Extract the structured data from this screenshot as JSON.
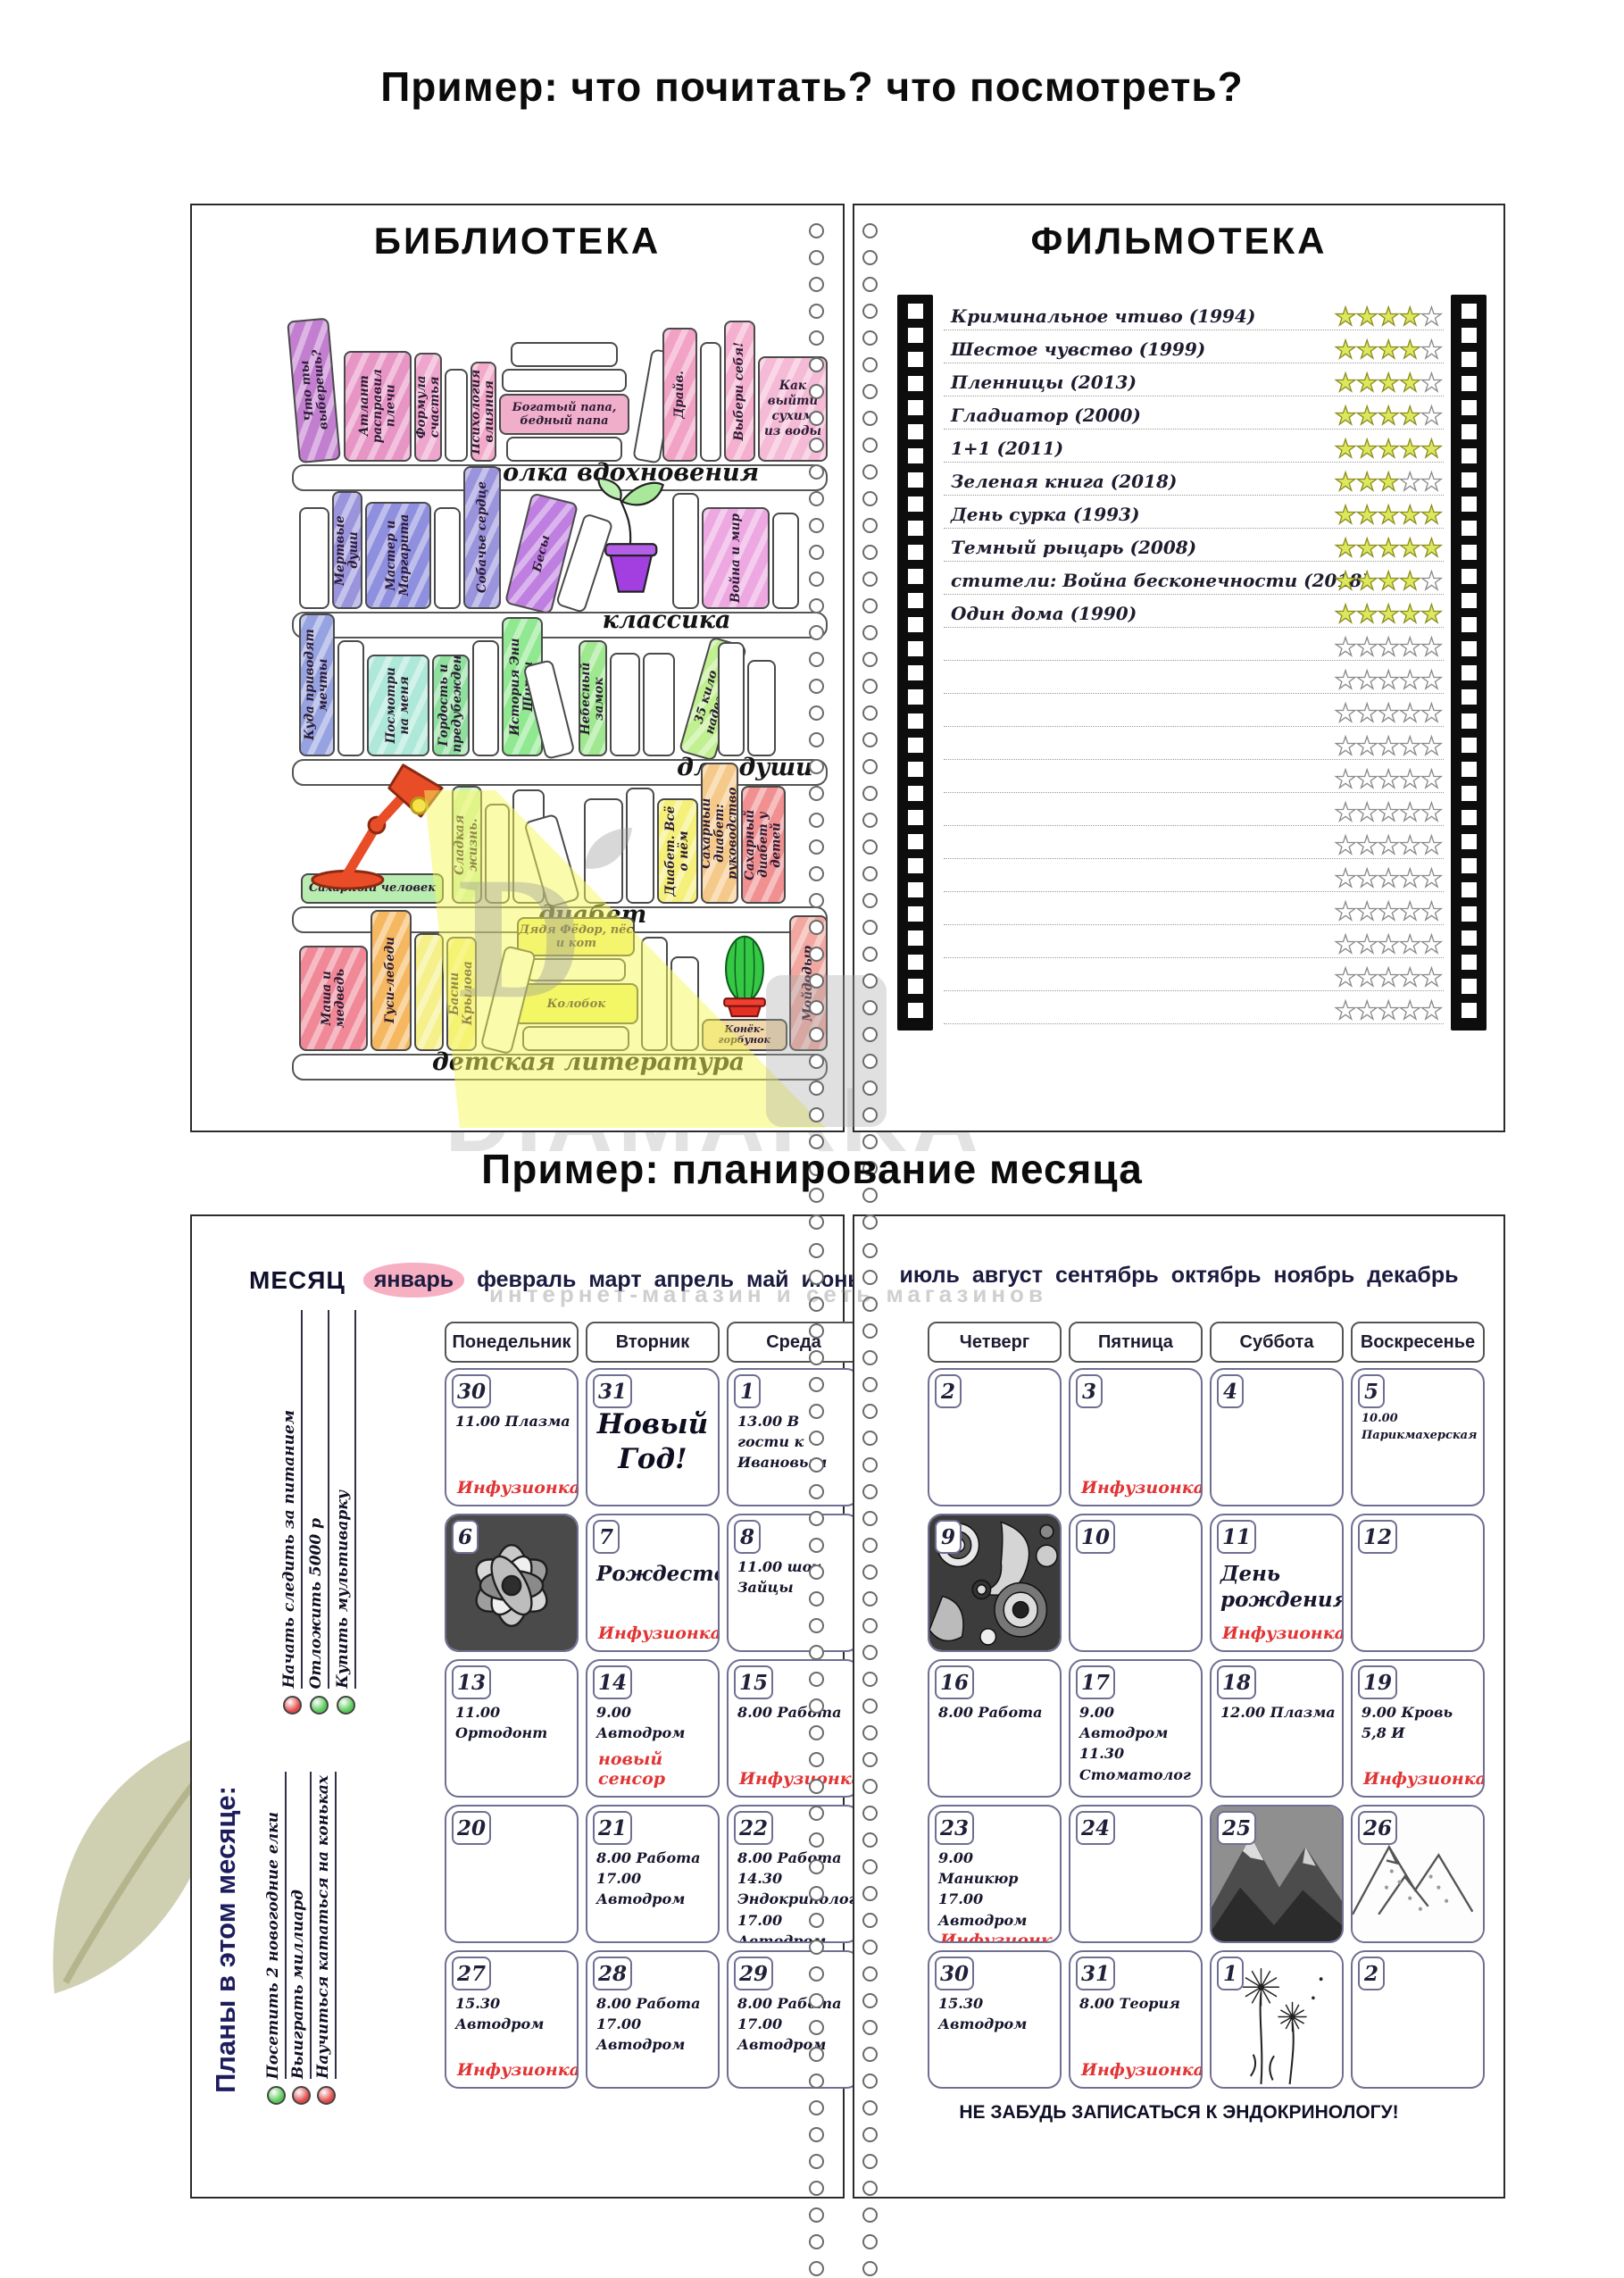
{
  "captions": {
    "top": "Пример: что почитать? что посмотреть?",
    "bottom": "Пример: планирование месяца"
  },
  "watermark": {
    "brand": "DIAMARKA",
    "subtitle": "интернет-магазин и сеть магазинов",
    "logo_letter": "D"
  },
  "library": {
    "title": "БИБЛИОТЕКА",
    "shelves": [
      {
        "label": "полка вдохновения",
        "books": [
          {
            "t": "Что ты выберешь?",
            "c": "#c27fd0",
            "w": 48,
            "h": 160,
            "tilt": -5
          },
          {
            "t": "Атлант расправил плечи",
            "c": "#e795c5",
            "w": 78,
            "h": 124
          },
          {
            "t": "Формула счастья",
            "c": "#eea6cd",
            "w": 32,
            "h": 122
          },
          {
            "t": "",
            "c": "#ffffff",
            "w": 26,
            "h": 104
          },
          {
            "t": "Психология влияния",
            "c": "#f3a9c9",
            "w": 30,
            "h": 112
          },
          {
            "kind": "stack",
            "books": [
              {
                "t": "",
                "c": "#ffffff",
                "w": 120,
                "h": 28
              },
              {
                "t": "",
                "c": "#ffffff",
                "w": 140,
                "h": 26
              },
              {
                "t": "Богатый папа, бедный папа",
                "c": "#f0aecb",
                "w": 146,
                "h": 46
              },
              {
                "t": "",
                "c": "#ffffff",
                "w": 130,
                "h": 28
              }
            ]
          },
          {
            "t": "",
            "c": "#ffffff",
            "w": 32,
            "h": 126,
            "tilt": 10
          },
          {
            "t": "Драйв.",
            "c": "#f2a2c4",
            "w": 40,
            "h": 150
          },
          {
            "t": "",
            "c": "#ffffff",
            "w": 24,
            "h": 134
          },
          {
            "t": "Выбери себя!",
            "c": "#f4b0ce",
            "w": 36,
            "h": 158
          },
          {
            "t": "Как выйти сухим из воды",
            "c": "#f4bad6",
            "w": 80,
            "h": 118,
            "flat": true
          }
        ]
      },
      {
        "label": "классика",
        "books": [
          {
            "t": "",
            "c": "#ffffff",
            "w": 34,
            "h": 114
          },
          {
            "t": "Мертвые души",
            "c": "#9a94dd",
            "w": 34,
            "h": 132
          },
          {
            "t": "Мастер и Маргарита",
            "c": "#8f8fdf",
            "w": 74,
            "h": 120
          },
          {
            "t": "",
            "c": "#ffffff",
            "w": 30,
            "h": 114
          },
          {
            "t": "Собачье сердце",
            "c": "#9a94dd",
            "w": 42,
            "h": 160
          },
          {
            "t": "Бесы",
            "c": "#bf7fe0",
            "w": 54,
            "h": 128,
            "tilt": 14
          },
          {
            "t": "",
            "c": "#ffffff",
            "w": 34,
            "h": 108,
            "tilt": 18
          },
          {
            "kind": "plant"
          },
          {
            "t": "",
            "c": "#ffffff",
            "w": 30,
            "h": 130
          },
          {
            "t": "Война и мир",
            "c": "#eda8e2",
            "w": 76,
            "h": 114
          },
          {
            "t": "",
            "c": "#ffffff",
            "w": 30,
            "h": 108
          }
        ]
      },
      {
        "label": "для души",
        "books": [
          {
            "t": "Куда приводят мечты",
            "c": "#97a3e0",
            "w": 40,
            "h": 160
          },
          {
            "t": "",
            "c": "#ffffff",
            "w": 30,
            "h": 130
          },
          {
            "t": "Посмотри на меня",
            "c": "#aee8d8",
            "w": 70,
            "h": 114
          },
          {
            "t": "Гордость и предубеждение",
            "c": "#8fdf9f",
            "w": 42,
            "h": 114
          },
          {
            "t": "",
            "c": "#ffffff",
            "w": 30,
            "h": 130
          },
          {
            "t": "История Эни Ширли",
            "c": "#90e890",
            "w": 46,
            "h": 156
          },
          {
            "t": "",
            "c": "#ffffff",
            "w": 34,
            "h": 108,
            "tilt": -14
          },
          {
            "t": "Небесный замок",
            "c": "#9fe88f",
            "w": 32,
            "h": 130
          },
          {
            "t": "",
            "c": "#ffffff",
            "w": 34,
            "h": 116
          },
          {
            "t": "",
            "c": "#ffffff",
            "w": 36,
            "h": 116
          },
          {
            "t": "35 кило надежды",
            "c": "#c0f090",
            "w": 42,
            "h": 134,
            "tilt": 16
          },
          {
            "t": "",
            "c": "#ffffff",
            "w": 30,
            "h": 128
          },
          {
            "t": "",
            "c": "#ffffff",
            "w": 32,
            "h": 108
          }
        ]
      },
      {
        "label": "диабет",
        "books": [
          {
            "kind": "lampstack",
            "base": "Сахарный человек"
          },
          {
            "t": "Сладкая жизнь.",
            "c": "#c9f0b8",
            "w": 34,
            "h": 132
          },
          {
            "t": "",
            "c": "#ffffff",
            "w": 28,
            "h": 112
          },
          {
            "t": "",
            "c": "#ffffff",
            "w": 36,
            "h": 128
          },
          {
            "t": "",
            "c": "#ffffff",
            "w": 38,
            "h": 100,
            "tilt": -16
          },
          {
            "t": "",
            "c": "#ffffff",
            "w": 44,
            "h": 118
          },
          {
            "t": "",
            "c": "#ffffff",
            "w": 32,
            "h": 130
          },
          {
            "t": "Диабет. Всё о нём",
            "c": "#f5f07a",
            "w": 46,
            "h": 118
          },
          {
            "t": "Сахарный диабет: руководство",
            "c": "#f5c98a",
            "w": 42,
            "h": 158
          },
          {
            "t": "Сахарный диабет у детей",
            "c": "#f09090",
            "w": 50,
            "h": 132
          }
        ]
      },
      {
        "label": "детская литература",
        "books": [
          {
            "t": "Маша и медведь",
            "c": "#f08898",
            "w": 78,
            "h": 118
          },
          {
            "t": "Гуси-лебеди",
            "c": "#f5b860",
            "w": 46,
            "h": 158
          },
          {
            "t": "",
            "c": "#f5f08a",
            "w": 34,
            "h": 132
          },
          {
            "t": "Басни Крылова",
            "c": "#f5ee8a",
            "w": 34,
            "h": 128
          },
          {
            "t": "",
            "c": "#ffffff",
            "w": 36,
            "h": 118,
            "tilt": 14
          },
          {
            "kind": "stack",
            "books": [
              {
                "t": "Дядя Фёдор, пёс и кот",
                "c": "#f0f080",
                "w": 132,
                "h": 44
              },
              {
                "t": "",
                "c": "#ffffff",
                "w": 112,
                "h": 26
              },
              {
                "t": "Колобок",
                "c": "#eef570",
                "w": 140,
                "h": 46
              },
              {
                "t": "",
                "c": "#ffffff",
                "w": 120,
                "h": 28
              }
            ]
          },
          {
            "t": "",
            "c": "#ffffff",
            "w": 30,
            "h": 128
          },
          {
            "t": "",
            "c": "#ffffff",
            "w": 32,
            "h": 106
          },
          {
            "kind": "cactus",
            "base": "Конёк-горбунок"
          },
          {
            "t": "Мойдодыр",
            "c": "#f2a8a0",
            "w": 44,
            "h": 152
          }
        ]
      }
    ]
  },
  "filmoteka": {
    "title": "ФИЛЬМОТЕКА",
    "max_stars": 5,
    "empty_rows": 12,
    "films": [
      {
        "title": "Криминальное чтиво (1994)",
        "stars": 4
      },
      {
        "title": "Шестое чувство (1999)",
        "stars": 4
      },
      {
        "title": "Пленницы (2013)",
        "stars": 4
      },
      {
        "title": "Гладиатор (2000)",
        "stars": 4
      },
      {
        "title": "1+1 (2011)",
        "stars": 5
      },
      {
        "title": "Зеленая книга (2018)",
        "stars": 3
      },
      {
        "title": "День сурка (1993)",
        "stars": 5
      },
      {
        "title": "Темный рыцарь (2008)",
        "stars": 5
      },
      {
        "title": "стители: Война бесконечности (2018)",
        "stars": 4
      },
      {
        "title": "Один дома (1990)",
        "stars": 5
      }
    ]
  },
  "planner": {
    "month_label": "МЕСЯЦ",
    "selected_month": "январь",
    "months_left": [
      "январь",
      "февраль",
      "март",
      "апрель",
      "май",
      "июнь"
    ],
    "months_right": [
      "июль",
      "август",
      "сентябрь",
      "октябрь",
      "ноябрь",
      "декабрь"
    ],
    "weekdays_left": [
      "Понедельник",
      "Вторник",
      "Среда"
    ],
    "weekdays_right": [
      "Четверг",
      "Пятница",
      "Суббота",
      "Воскресенье"
    ],
    "goals_top": [
      {
        "text": "Начать следить за питанием",
        "color": "#e04848"
      },
      {
        "text": "Отложить 5000 р",
        "color": "#55c855"
      },
      {
        "text": "Купить мультиварку",
        "color": "#55c855"
      }
    ],
    "plans_title": "Планы в этом месяце:",
    "plans": [
      {
        "text": "Посетить 2 новогодние елки",
        "color": "#55c855"
      },
      {
        "text": "Выиграть миллиард",
        "color": "#e04848"
      },
      {
        "text": "Научиться кататься на коньках",
        "color": "#e04848"
      }
    ],
    "cells_left": [
      {
        "day": "30",
        "lines": [
          "11.00 Плазма"
        ],
        "accent": "Инфузионка"
      },
      {
        "day": "31",
        "big": "Новый Год!"
      },
      {
        "day": "1",
        "lines": [
          "13.00 В гости к Ивановым"
        ]
      },
      {
        "day": "6",
        "image": "lily"
      },
      {
        "day": "7",
        "lines": [
          "Рождество"
        ],
        "em": true,
        "accent": "Инфузионка"
      },
      {
        "day": "8",
        "lines": [
          "11.00 шоу Зайцы"
        ]
      },
      {
        "day": "13",
        "lines": [
          "11.00 Ортодонт"
        ]
      },
      {
        "day": "14",
        "lines": [
          "9.00 Автодром"
        ],
        "accent": "новый сенсор"
      },
      {
        "day": "15",
        "lines": [
          "8.00 Работа"
        ],
        "accent": "Инфузионка"
      },
      {
        "day": "20"
      },
      {
        "day": "21",
        "lines": [
          "8.00 Работа",
          "17.00 Автодром"
        ]
      },
      {
        "day": "22",
        "lines": [
          "8.00 Работа",
          "14.30 Эндокринолог",
          "17.00 Автодром"
        ]
      },
      {
        "day": "27",
        "lines": [
          "15.30 Автодром"
        ],
        "accent": "Инфузионка"
      },
      {
        "day": "28",
        "lines": [
          "8.00 Работа",
          "17.00 Автодром"
        ]
      },
      {
        "day": "29",
        "lines": [
          "8.00 Работа",
          "17.00 Автодром"
        ]
      }
    ],
    "cells_right": [
      {
        "day": "2"
      },
      {
        "day": "3",
        "accent": "Инфузионка"
      },
      {
        "day": "4"
      },
      {
        "day": "5",
        "lines": [
          "10.00 Парикмахерская"
        ],
        "small": true
      },
      {
        "day": "9",
        "image": "paisley"
      },
      {
        "day": "10"
      },
      {
        "day": "11",
        "lines": [
          "День рождения!"
        ],
        "em": true,
        "accent": "Инфузионка"
      },
      {
        "day": "12"
      },
      {
        "day": "16",
        "lines": [
          "8.00 Работа"
        ]
      },
      {
        "day": "17",
        "lines": [
          "9.00 Автодром",
          "11.30 Стоматолог"
        ]
      },
      {
        "day": "18",
        "lines": [
          "12.00 Плазма"
        ]
      },
      {
        "day": "19",
        "lines": [
          "9.00 Кровь",
          "5,8 И"
        ],
        "accent": "Инфузионка"
      },
      {
        "day": "23",
        "lines": [
          "9.00 Маникюр",
          "17.00 Автодром"
        ],
        "accent": "Инфузионка"
      },
      {
        "day": "24"
      },
      {
        "day": "25",
        "image": "mountain_dark"
      },
      {
        "day": "26",
        "image": "mountain_light"
      },
      {
        "day": "30",
        "lines": [
          "15.30 Автодром"
        ]
      },
      {
        "day": "31",
        "lines": [
          "8.00 Теория"
        ],
        "accent": "Инфузионка"
      },
      {
        "day": "1",
        "image": "dandelion"
      },
      {
        "day": "2"
      }
    ],
    "footer_note": "НЕ ЗАБУДЬ ЗАПИСАТЬСЯ К ЭНДОКРИНОЛОГУ!"
  }
}
